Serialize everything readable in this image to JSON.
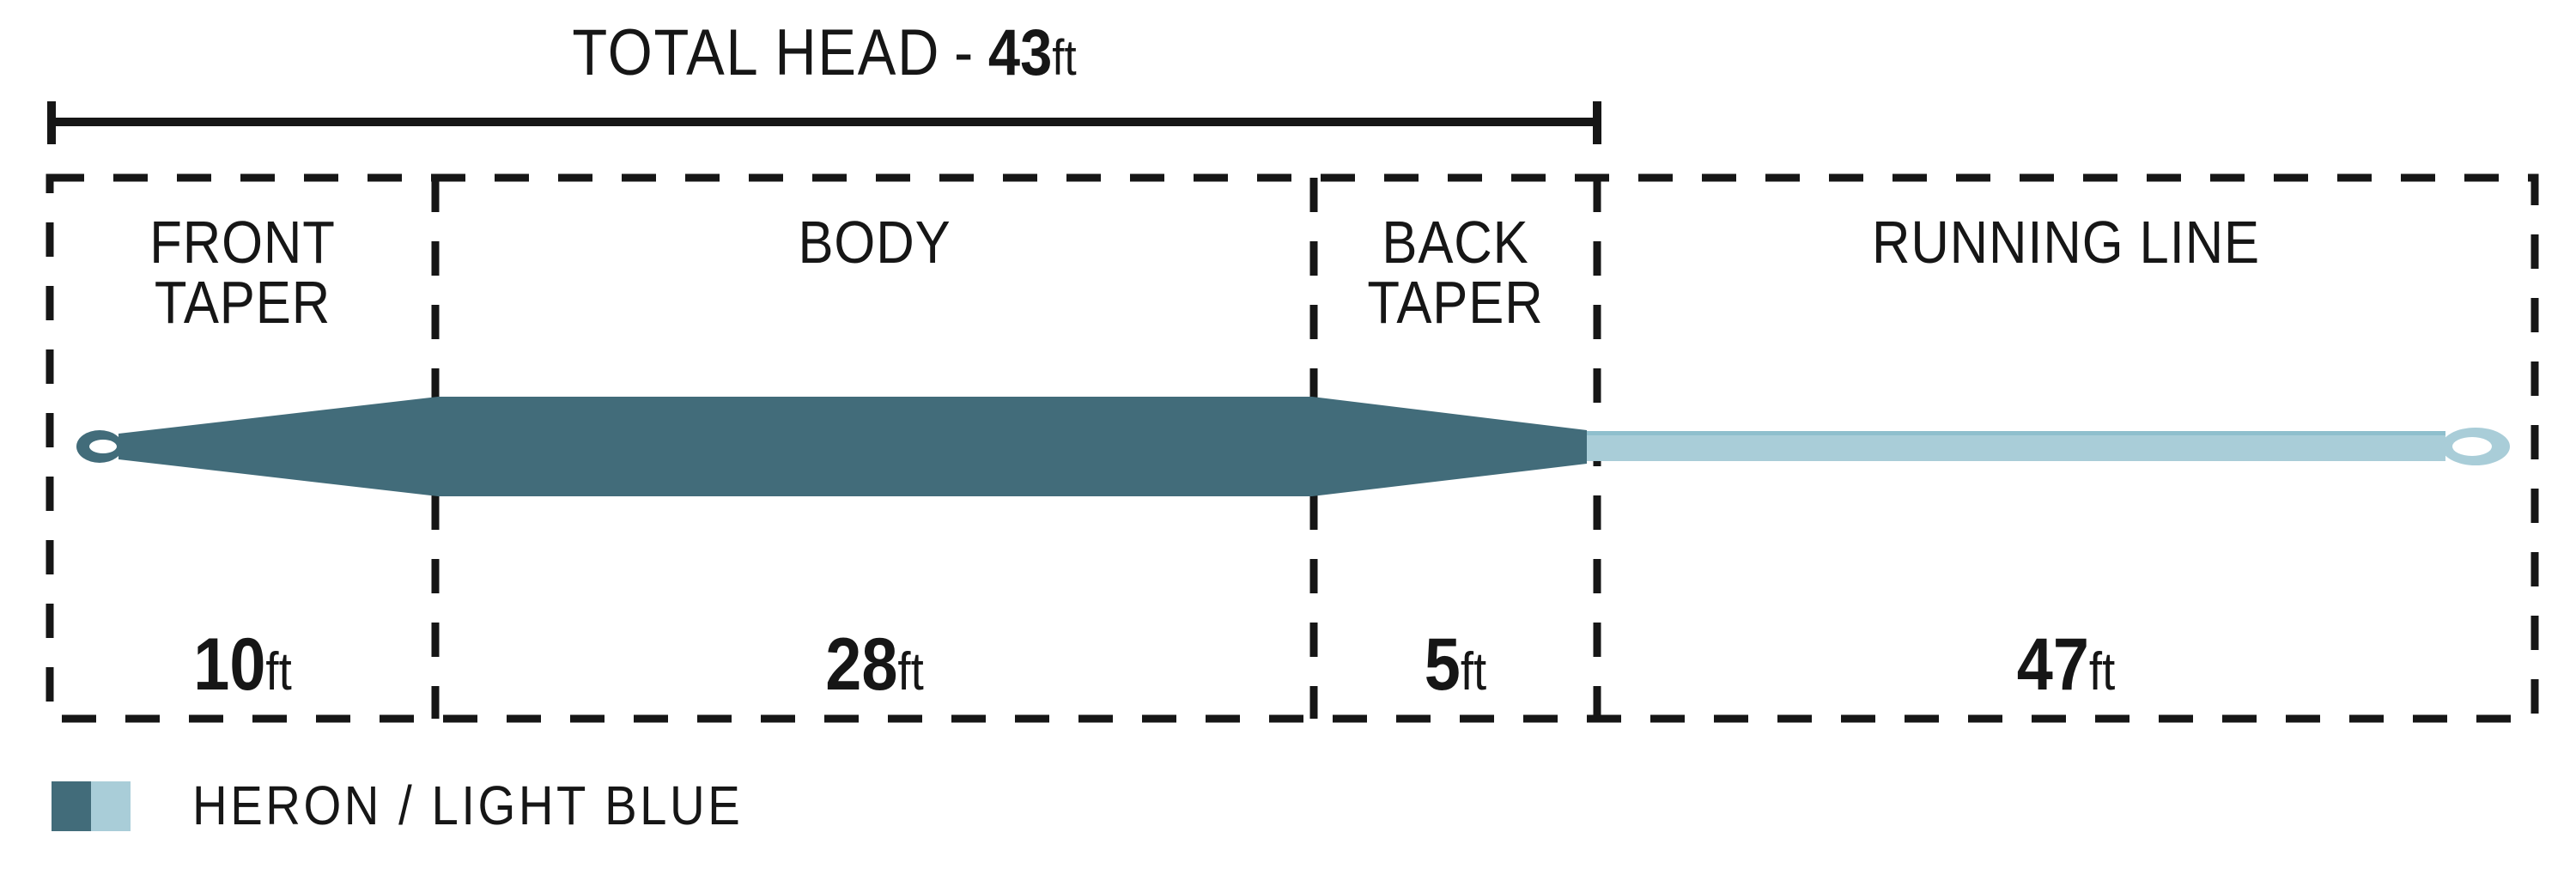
{
  "title": {
    "label": "TOTAL HEAD",
    "separator": "-",
    "value": "43",
    "unit": "ft"
  },
  "sections": [
    {
      "name": "front-taper",
      "label_lines": [
        "FRONT",
        "TAPER"
      ],
      "length": "10",
      "unit": "ft"
    },
    {
      "name": "body",
      "label_lines": [
        "BODY"
      ],
      "length": "28",
      "unit": "ft"
    },
    {
      "name": "back-taper",
      "label_lines": [
        "BACK",
        "TAPER"
      ],
      "length": "5",
      "unit": "ft"
    },
    {
      "name": "running-line",
      "label_lines": [
        "RUNNING LINE"
      ],
      "length": "47",
      "unit": "ft"
    }
  ],
  "legend": {
    "label": "HERON / LIGHT BLUE"
  },
  "colors": {
    "heron": "#426C7A",
    "light_blue": "#A9CDD8",
    "running_line_edge": "#8FBFCD",
    "ink": "#161616"
  }
}
